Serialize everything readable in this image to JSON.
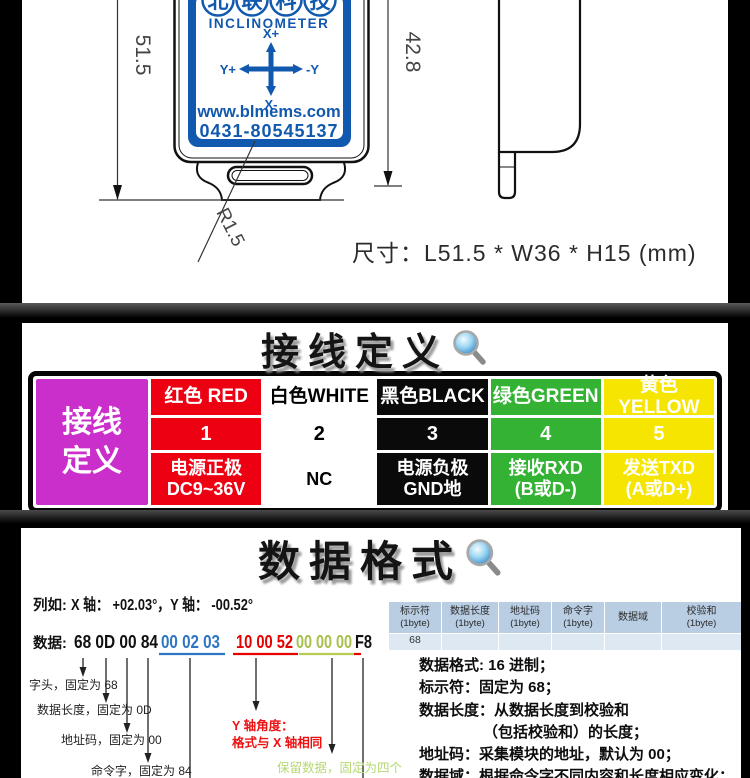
{
  "drawing": {
    "logo_chars": [
      "北",
      "联",
      "科",
      "技"
    ],
    "logo_subtitle": "INCLINOMETER",
    "axis": {
      "up": "X+",
      "down": "X-",
      "left": "Y+",
      "right": "-Y"
    },
    "website": "www.blmems.com",
    "phone": "0431-80545137",
    "dim_left": "51.5",
    "dim_right": "42.8",
    "radius_label": "R1.5",
    "caption": "尺寸：L51.5 * W36 * H15 (mm)",
    "label_blue": "#1159ae"
  },
  "wiring": {
    "title": "接线定义",
    "header_line1": "接线",
    "header_line2": "定义",
    "header_bg": "#cb2fcb",
    "header_fg": "#ffffff",
    "columns": [
      {
        "name": "红色 RED",
        "pin": "1",
        "func": "电源正极",
        "func2": "DC9~36V",
        "bg": "#ec0011",
        "fg": "#ffffff"
      },
      {
        "name": "白色WHITE",
        "pin": "2",
        "func": "NC",
        "func2": "",
        "bg": "#ffffff",
        "fg": "#000000"
      },
      {
        "name": "黑色BLACK",
        "pin": "3",
        "func": "电源负极",
        "func2": "GND地",
        "bg": "#0a0a0a",
        "fg": "#ffffff"
      },
      {
        "name": "绿色GREEN",
        "pin": "4",
        "func": "接收RXD",
        "func2": "(B或D-)",
        "bg": "#33b233",
        "fg": "#ffffff"
      },
      {
        "name": "黄色YELLOW",
        "pin": "5",
        "func": "发送TXD",
        "func2": "(A或D+)",
        "bg": "#f6e500",
        "fg": "#ffffff"
      }
    ]
  },
  "dataformat": {
    "title": "数据格式",
    "example_label": "列如:",
    "example_text": "X 轴： +02.03°，Y 轴： -00.52°",
    "data_label": "数据:",
    "hex_head": "68 0D 00 84",
    "hex_x": "00 02 03",
    "hex_y": "10 00 52",
    "hex_reserved": "00 00 00",
    "hex_checksum": "F8",
    "hex_colors": {
      "black": "#111111",
      "blue": "#2e75c3",
      "red": "#e60000",
      "green": "#a8c04d"
    },
    "table": {
      "headers": [
        {
          "l1": "标示符",
          "l2": "(1byte)"
        },
        {
          "l1": "数据长度",
          "l2": "(1byte)"
        },
        {
          "l1": "地址码",
          "l2": "(1byte)"
        },
        {
          "l1": "命令字",
          "l2": "(1byte)"
        },
        {
          "l1": "数据域",
          "l2": ""
        },
        {
          "l1": "校验和",
          "l2": "(1byte)"
        }
      ],
      "row": [
        "68",
        "",
        "",
        "",
        "",
        ""
      ],
      "header_bg": "#b9cde3",
      "row_bg": "#dde8f3"
    },
    "annotations": {
      "head": "字头，固定为 68",
      "length": "数据长度，固定为 0D",
      "address": "地址码，固定为 00",
      "command": "命令字，固定为 84",
      "y_axis_1": "Y 轴角度：",
      "y_axis_2": "格式与 X 轴相同",
      "reserved": "保留数据，固定为四个",
      "red": "#ee1111",
      "green": "#b7d873"
    },
    "notes": [
      "数据格式: 16 进制；",
      "标示符：固定为 68；",
      "数据长度：从数据长度到校验和",
      "（包括校验和）的长度；",
      "地址码：采集模块的地址，默认为 00；",
      "数据域：根据命令字不同内容和长度相应变化；"
    ]
  }
}
